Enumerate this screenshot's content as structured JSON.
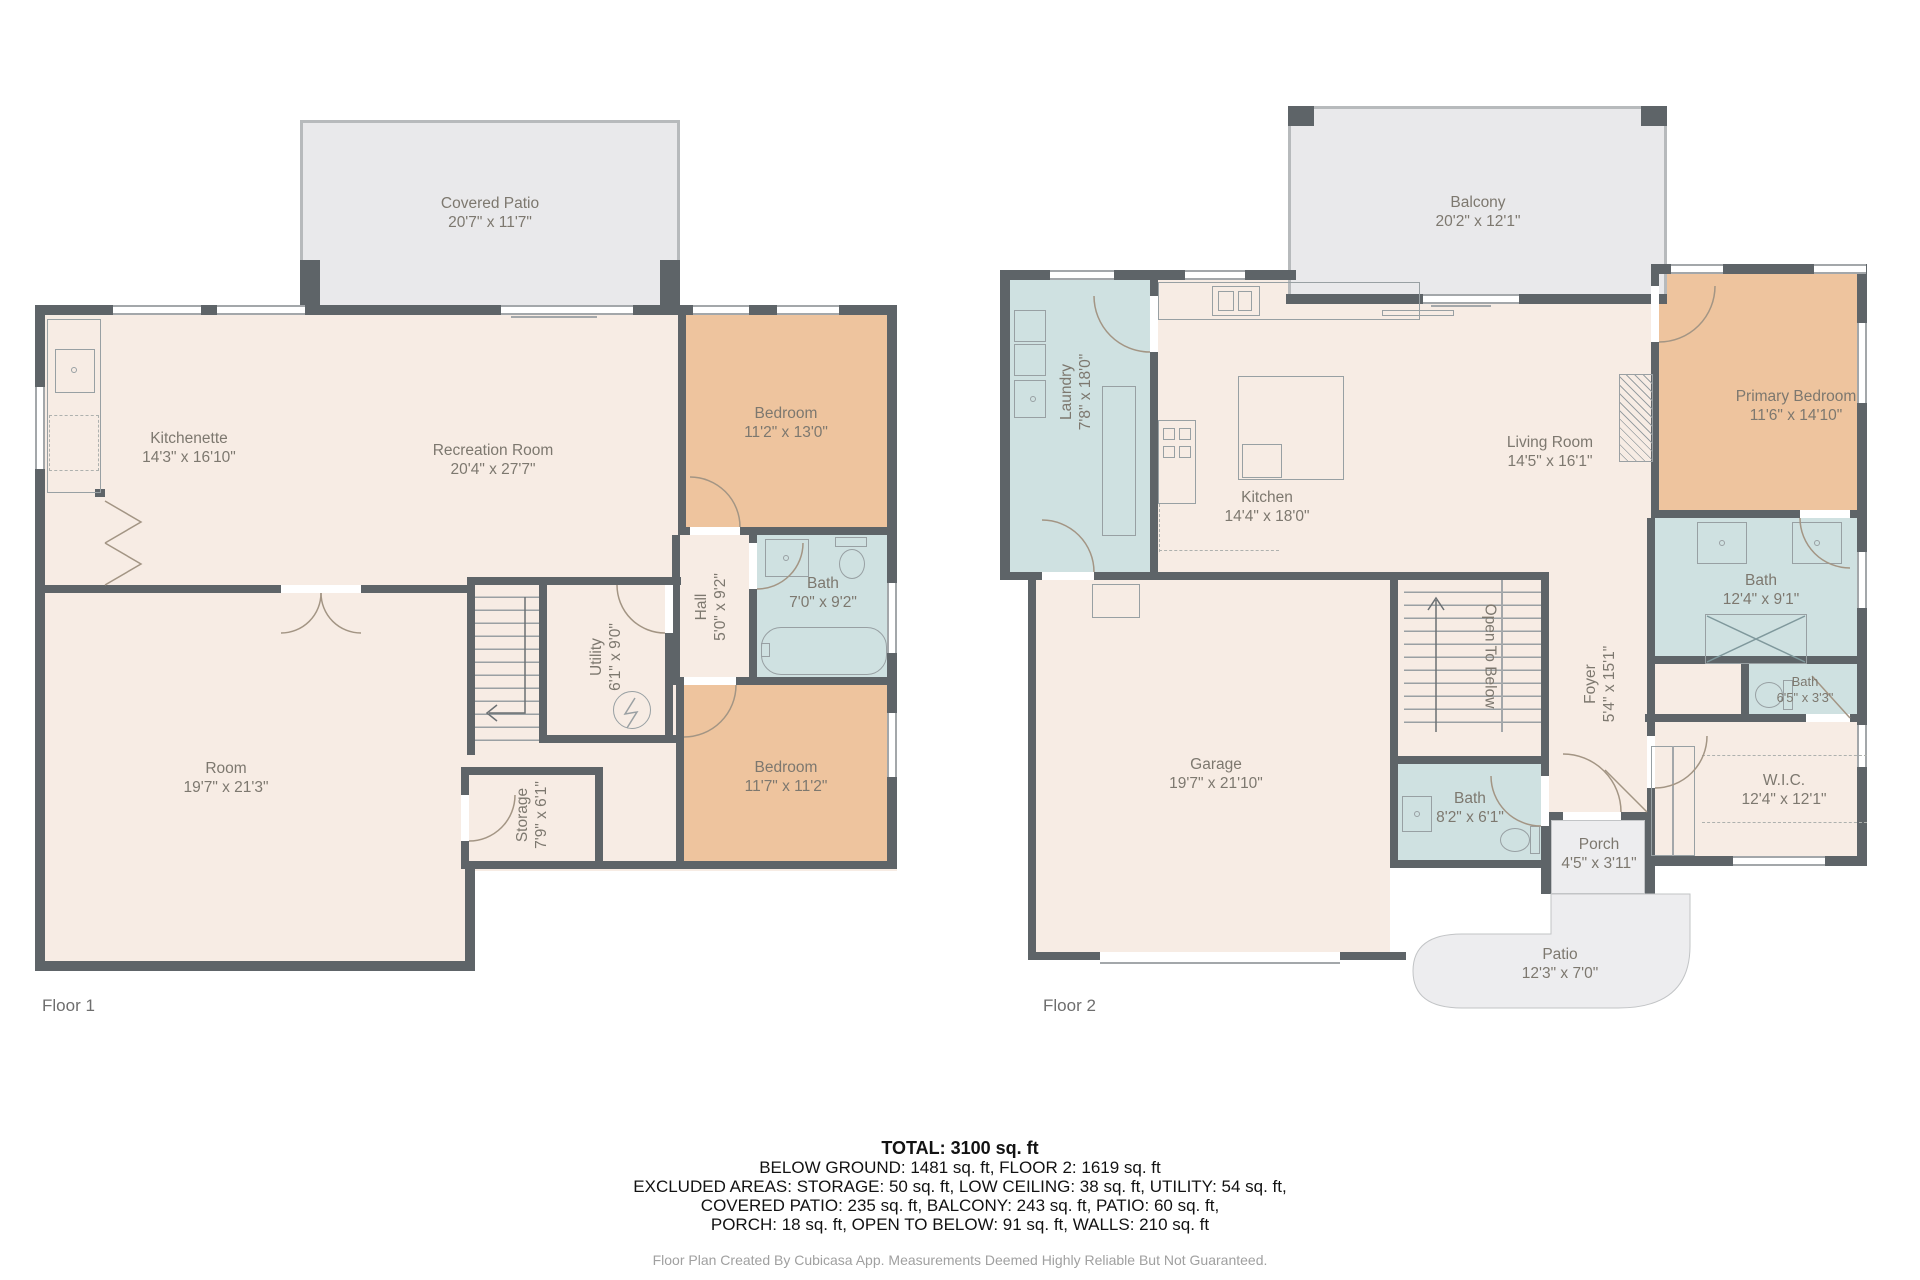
{
  "colors": {
    "wall": "#5e6468",
    "floor": "#f7ece4",
    "bedroom": "#eec49e",
    "bath": "#cfe1e1",
    "outdoor_covered": "#e9e9eb",
    "outdoor_open": "#ededef"
  },
  "floor1": {
    "label": "Floor 1",
    "rooms": {
      "covered_patio": {
        "name": "Covered Patio",
        "dims": "20'7\" x 11'7\""
      },
      "kitchenette": {
        "name": "Kitchenette",
        "dims": "14'3\" x 16'10\""
      },
      "recreation": {
        "name": "Recreation Room",
        "dims": "20'4\" x 27'7\""
      },
      "bedroom1": {
        "name": "Bedroom",
        "dims": "11'2\" x 13'0\""
      },
      "bath": {
        "name": "Bath",
        "dims": "7'0\" x 9'2\""
      },
      "hall": {
        "name": "Hall",
        "dims": "5'0\" x 9'2\""
      },
      "utility": {
        "name": "Utility",
        "dims": "6'1\" x 9'0\""
      },
      "room": {
        "name": "Room",
        "dims": "19'7\" x 21'3\""
      },
      "storage": {
        "name": "Storage",
        "dims": "7'9\" x 6'1\""
      },
      "bedroom2": {
        "name": "Bedroom",
        "dims": "11'7\" x 11'2\""
      }
    }
  },
  "floor2": {
    "label": "Floor 2",
    "rooms": {
      "balcony": {
        "name": "Balcony",
        "dims": "20'2\" x 12'1\""
      },
      "laundry": {
        "name": "Laundry",
        "dims": "7'8\" x 18'0\""
      },
      "kitchen": {
        "name": "Kitchen",
        "dims": "14'4\" x 18'0\""
      },
      "living": {
        "name": "Living Room",
        "dims": "14'5\" x 16'1\""
      },
      "primary": {
        "name": "Primary Bedroom",
        "dims": "11'6\" x 14'10\""
      },
      "bath_main": {
        "name": "Bath",
        "dims": "12'4\" x 9'1\""
      },
      "bath_small": {
        "name": "Bath",
        "dims": "6'5\" x 3'3\""
      },
      "wic": {
        "name": "W.I.C.",
        "dims": "12'4\" x 12'1\""
      },
      "foyer": {
        "name": "Foyer",
        "dims": "5'4\" x 15'1\""
      },
      "open_below": {
        "name": "Open To Below"
      },
      "garage": {
        "name": "Garage",
        "dims": "19'7\" x 21'10\""
      },
      "bath_garage": {
        "name": "Bath",
        "dims": "8'2\" x 6'1\""
      },
      "porch": {
        "name": "Porch",
        "dims": "4'5\" x 3'11\""
      },
      "patio": {
        "name": "Patio",
        "dims": "12'3\" x 7'0\""
      }
    }
  },
  "summary": {
    "total": "TOTAL: 3100 sq. ft",
    "line2": "BELOW GROUND: 1481 sq. ft, FLOOR 2: 1619 sq. ft",
    "line3": "EXCLUDED AREAS: STORAGE: 50 sq. ft, LOW CEILING: 38 sq. ft, UTILITY: 54 sq. ft,",
    "line4": "COVERED PATIO: 235 sq. ft, BALCONY: 243 sq. ft, PATIO: 60 sq. ft,",
    "line5": "PORCH: 18 sq. ft, OPEN TO BELOW: 91 sq. ft, WALLS: 210 sq. ft"
  },
  "footer": "Floor Plan Created By Cubicasa App. Measurements Deemed Highly Reliable But Not Guaranteed."
}
